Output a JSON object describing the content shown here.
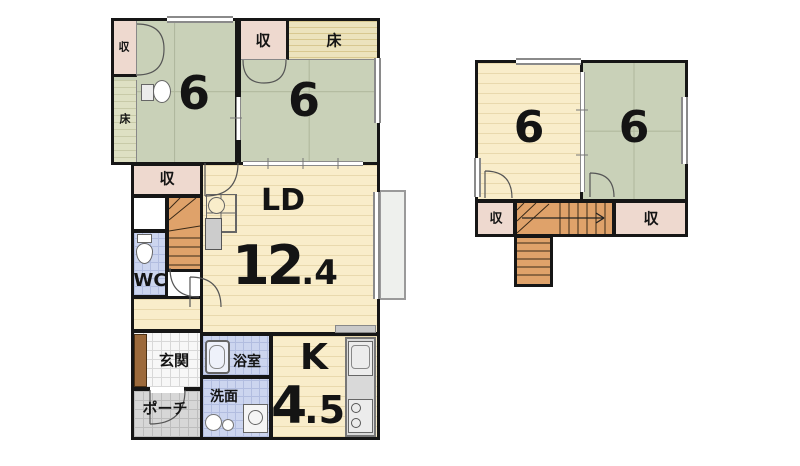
{
  "floor1": {
    "jp_room_left": {
      "area": "6",
      "closet_label": "収",
      "tokonoma_label": "床"
    },
    "jp_room_right": {
      "area": "6",
      "closet_label": "収",
      "tokonoma_label": "床"
    },
    "hall_closet_label": "収",
    "wc_label": "WC",
    "living_dining": {
      "label": "LD",
      "area_int": "12",
      "area_dec": ".4"
    },
    "entrance_label": "玄関",
    "porch_label": "ポーチ",
    "bath_label": "浴室",
    "washroom_label": "洗面",
    "kitchen": {
      "label": "K",
      "area_int": "4",
      "area_dec": ".5"
    }
  },
  "floor2": {
    "west_room_area": "6",
    "jp_room_area": "6",
    "closet_left_label": "収",
    "closet_right_label": "収"
  },
  "icons": {
    "vanity": "vanity-icon",
    "toilet": "toilet-icon",
    "bathtub": "bathtub-icon",
    "washing_machine": "washing-machine-icon",
    "laundry_basin": "laundry-basin-icon",
    "kitchen_sink": "kitchen-sink-icon",
    "stove": "stove-icon",
    "desk": "desk-counter-icon"
  },
  "colors": {
    "wall": "#161616",
    "tatami_green": "#c9d1b8",
    "wood_floor": "#f9edca",
    "closet_pink": "#eed9cf",
    "tokonoma_top": "#ece3bd",
    "tokonoma_side": "#dee0c3",
    "stairs_orange": "#dfa26a",
    "water_blue": "#ccd5ef",
    "entrance_tile": "#f7f7f7",
    "porch_gray": "#d7d7d7",
    "deck_gray": "#eef0ed",
    "counter_gray": "#d9d9d9",
    "cabinet_brown": "#9c6a3c"
  }
}
